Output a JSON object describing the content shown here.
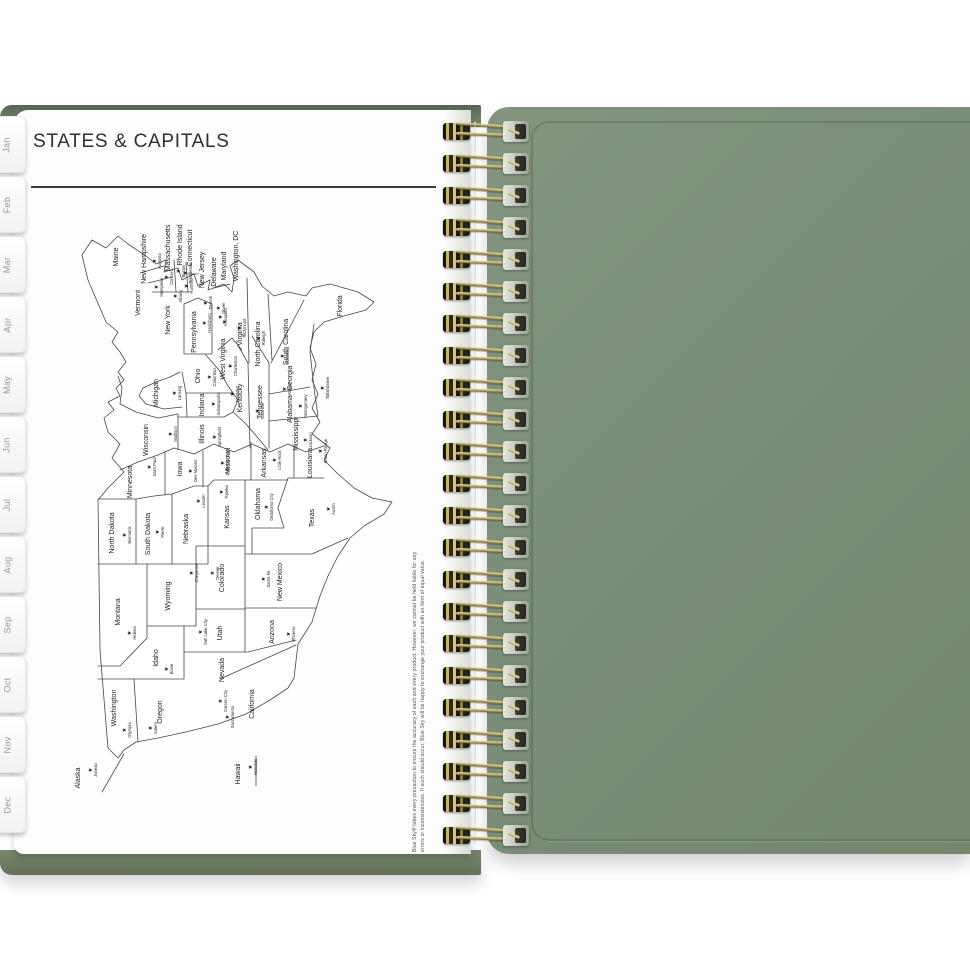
{
  "page": {
    "title": "STATES & CAPITALS",
    "disclaimer": {
      "line1": "Blue Sky® takes every precaution to ensure the accuracy of each and every product. However, we cannot be held liable for any",
      "line2": "errors or inconsistencies. If such should occur, Blue Sky will be happy to exchange your product with an item of equal value."
    }
  },
  "tabs": [
    "Jan",
    "Feb",
    "Mar",
    "Apr",
    "May",
    "Jun",
    "Jul",
    "Aug",
    "Sep",
    "Oct",
    "Nov",
    "Dec"
  ],
  "binding": {
    "loop_count": 23,
    "wire_color": "#b39e5c"
  },
  "cover": {
    "color": "#7b8e7a"
  },
  "map": {
    "description": "United States map printed in landscape, rotated 90° on the page, each state labeled with its capital marked by a star",
    "states": [
      {
        "name": "Washington",
        "capital": "Olympia",
        "nx": 92,
        "ny": 54,
        "cx": 70,
        "cy": 62
      },
      {
        "name": "Oregon",
        "capital": "Salem",
        "nx": 88,
        "ny": 100,
        "cx": 72,
        "cy": 88
      },
      {
        "name": "California",
        "capital": "Sacramento",
        "nx": 96,
        "ny": 192,
        "cx": 83,
        "cy": 165
      },
      {
        "name": "Nevada",
        "capital": "Carson City",
        "nx": 130,
        "ny": 162,
        "cx": 99,
        "cy": 158
      },
      {
        "name": "Idaho",
        "capital": "Boise",
        "nx": 142,
        "ny": 96,
        "cx": 131,
        "cy": 104
      },
      {
        "name": "Montana",
        "capital": "Helena",
        "nx": 188,
        "ny": 58,
        "cx": 167,
        "cy": 67
      },
      {
        "name": "Wyoming",
        "capital": "Cheyenne",
        "nx": 204,
        "ny": 108,
        "cx": 227,
        "cy": 129
      },
      {
        "name": "Utah",
        "capital": "Salt Lake City",
        "nx": 167,
        "ny": 160,
        "cx": 168,
        "cy": 138
      },
      {
        "name": "Arizona",
        "capital": "Phoenix",
        "nx": 168,
        "ny": 212,
        "cx": 166,
        "cy": 226
      },
      {
        "name": "Colorado",
        "capital": "Denver",
        "nx": 222,
        "ny": 162,
        "cx": 227,
        "cy": 150
      },
      {
        "name": "New Mexico",
        "capital": "Santa Fe",
        "nx": 218,
        "ny": 220,
        "cx": 221,
        "cy": 201
      },
      {
        "name": "North Dakota",
        "capital": "Bismarck",
        "nx": 267,
        "ny": 52,
        "cx": 265,
        "cy": 62
      },
      {
        "name": "South Dakota",
        "capital": "Pierre",
        "nx": 266,
        "ny": 88,
        "cx": 268,
        "cy": 95
      },
      {
        "name": "Nebraska",
        "capital": "Lincoln",
        "nx": 271,
        "ny": 126,
        "cx": 299,
        "cy": 136
      },
      {
        "name": "Kansas",
        "capital": "Topeka",
        "nx": 283,
        "ny": 167,
        "cx": 308,
        "cy": 159
      },
      {
        "name": "Oklahoma",
        "capital": "Oklahoma City",
        "nx": 296,
        "ny": 198,
        "cx": 293,
        "cy": 204
      },
      {
        "name": "Texas",
        "capital": "Austin",
        "nx": 282,
        "ny": 252,
        "cx": 291,
        "cy": 266
      },
      {
        "name": "Minnesota",
        "capital": "Saint Paul",
        "nx": 318,
        "ny": 70,
        "cx": 333,
        "cy": 87
      },
      {
        "name": "Iowa",
        "capital": "Des Moines",
        "nx": 331,
        "ny": 120,
        "cx": 329,
        "cy": 128
      },
      {
        "name": "Missouri",
        "capital": "Jefferson City",
        "nx": 339,
        "ny": 168,
        "cx": 337,
        "cy": 160
      },
      {
        "name": "Arkansas",
        "capital": "Little Rock",
        "nx": 337,
        "ny": 204,
        "cx": 340,
        "cy": 212
      },
      {
        "name": "Louisiana",
        "capital": "Baton Rouge",
        "nx": 337,
        "ny": 250,
        "cx": 349,
        "cy": 258
      },
      {
        "name": "Wisconsin",
        "capital": "Madison",
        "nx": 360,
        "ny": 86,
        "cx": 366,
        "cy": 108
      },
      {
        "name": "Illinois",
        "capital": "Springfield",
        "nx": 366,
        "ny": 142,
        "cx": 363,
        "cy": 152
      },
      {
        "name": "Mississippi",
        "capital": "Jackson",
        "nx": 366,
        "ny": 236,
        "cx": 360,
        "cy": 243
      },
      {
        "name": "Michigan",
        "capital": "Lansing",
        "nx": 407,
        "ny": 96,
        "cx": 407,
        "cy": 112
      },
      {
        "name": "Indiana",
        "capital": "Indianapolis",
        "nx": 395,
        "ny": 142,
        "cx": 396,
        "cy": 151
      },
      {
        "name": "Kentucky",
        "capital": "Frankfort",
        "nx": 402,
        "ny": 180,
        "cx": 406,
        "cy": 170
      },
      {
        "name": "Tennessee",
        "capital": "Nashville",
        "nx": 398,
        "ny": 200,
        "cx": 389,
        "cy": 195
      },
      {
        "name": "Alabama",
        "capital": "Montgomery",
        "nx": 391,
        "ny": 230,
        "cx": 394,
        "cy": 238
      },
      {
        "name": "Ohio",
        "capital": "Columbus",
        "nx": 424,
        "ny": 138,
        "cx": 423,
        "cy": 147
      },
      {
        "name": "Georgia",
        "capital": "Atlanta",
        "nx": 422,
        "ny": 230,
        "cx": 411,
        "cy": 222
      },
      {
        "name": "Florida",
        "capital": "Tallahassee",
        "nx": 494,
        "ny": 280,
        "cx": 412,
        "cy": 260
      },
      {
        "name": "South Carolina",
        "capital": "Columbia",
        "nx": 458,
        "ny": 226,
        "cx": 444,
        "cy": 220
      },
      {
        "name": "North Carolina",
        "capital": "Raleigh",
        "nx": 456,
        "ny": 198,
        "cx": 462,
        "cy": 196
      },
      {
        "name": "Virginia",
        "capital": "Richmond",
        "nx": 466,
        "ny": 180,
        "cx": 472,
        "cy": 177
      },
      {
        "name": "West Virginia",
        "capital": "Charleston",
        "nx": 441,
        "ny": 163,
        "cx": 434,
        "cy": 168
      },
      {
        "name": "Pennsylvania",
        "capital": "Harrisburg",
        "nx": 468,
        "ny": 134,
        "cx": 477,
        "cy": 142
      },
      {
        "name": "New York",
        "capital": "Albany",
        "nx": 480,
        "ny": 108,
        "cx": 504,
        "cy": 113
      },
      {
        "name": "Maine",
        "capital": "Augusta",
        "nx": 543,
        "ny": 56,
        "cx": 539,
        "cy": 92
      },
      {
        "name": "Vermont",
        "capital": "Montpelier",
        "nx": 497,
        "ny": 78,
        "cx": 513,
        "cy": 94
      },
      {
        "name": "New Hampshire",
        "capital": "Concord",
        "nx": 541,
        "ny": 84,
        "cx": 523,
        "cy": 104
      },
      {
        "name": "Massachusetts",
        "capital": "Boston",
        "nx": 552,
        "ny": 108,
        "cx": 529,
        "cy": 116
      },
      {
        "name": "Rhode Island",
        "capital": "Providence",
        "nx": 555,
        "ny": 120,
        "cx": 527,
        "cy": 123
      },
      {
        "name": "Connecticut",
        "capital": "Hartford",
        "nx": 552,
        "ny": 130,
        "cx": 514,
        "cy": 124
      },
      {
        "name": "New Jersey",
        "capital": "Trenton",
        "nx": 530,
        "ny": 142,
        "cx": 497,
        "cy": 143
      },
      {
        "name": "Delaware",
        "capital": "Dover",
        "nx": 528,
        "ny": 154,
        "cx": 492,
        "cy": 156
      },
      {
        "name": "Maryland",
        "capital": "Annapolis",
        "nx": 534,
        "ny": 164,
        "cx": 483,
        "cy": 158
      },
      {
        "name": "Washington, DC",
        "capital": "",
        "nx": 544,
        "ny": 176,
        "cx": 478,
        "cy": 162
      },
      {
        "name": "Alaska",
        "capital": "Juneau",
        "nx": 22,
        "ny": 18,
        "cx": 30,
        "cy": 28
      },
      {
        "name": "Hawaii",
        "capital": "Honolulu",
        "nx": 26,
        "ny": 178,
        "cx": 33,
        "cy": 188
      }
    ]
  }
}
